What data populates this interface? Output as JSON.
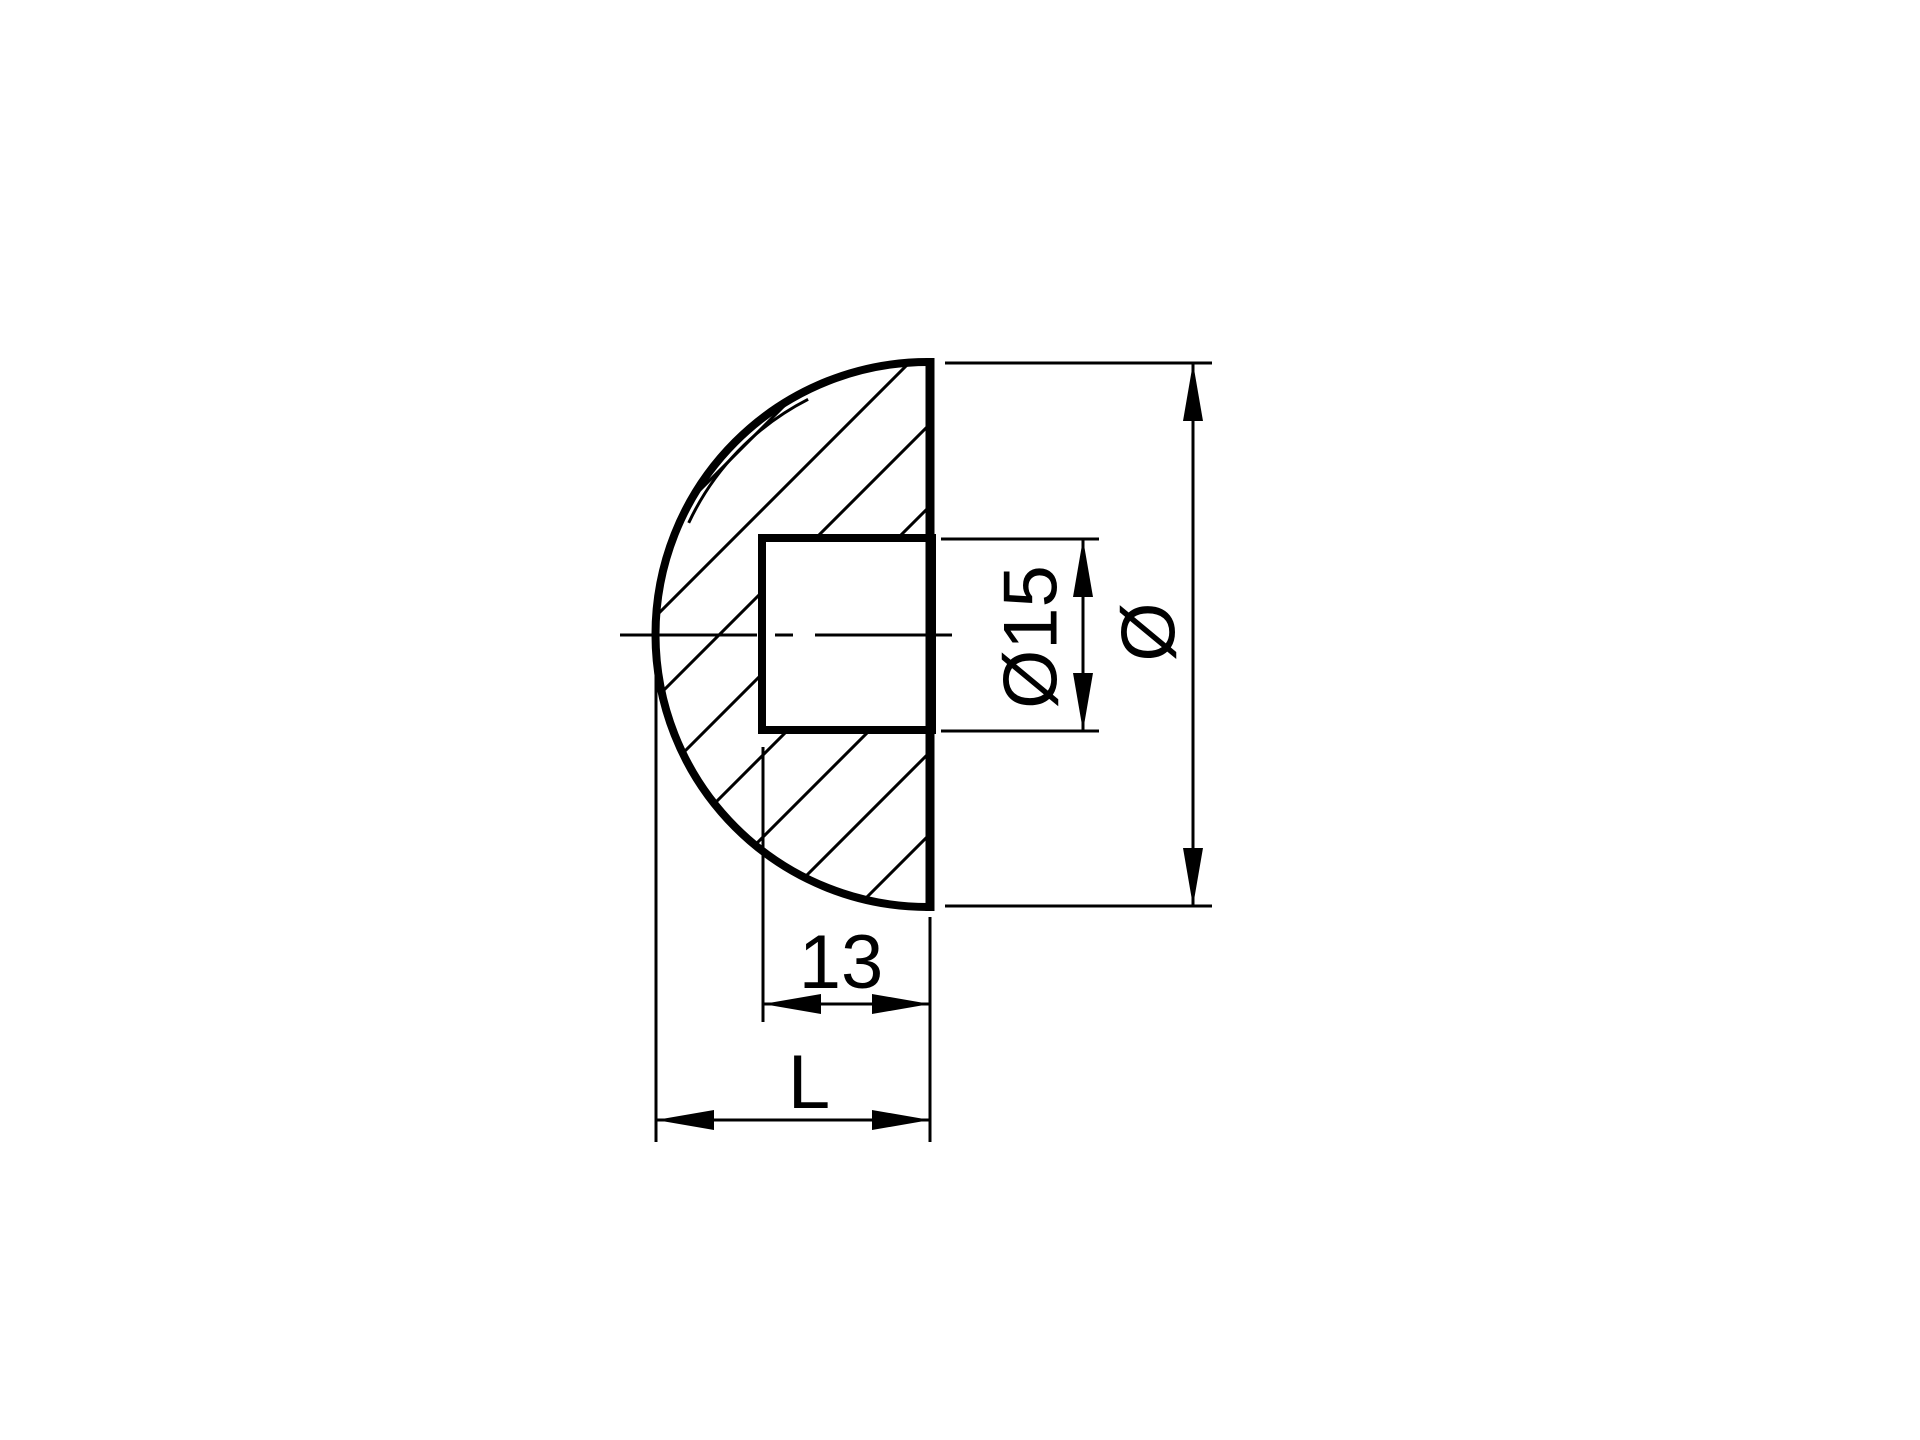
{
  "figure": {
    "kind": "technical-drawing-cross-section",
    "background_color": "#ffffff",
    "line_color": "#000000"
  },
  "dimensions": {
    "overall_diameter": {
      "label": "Ø"
    },
    "bore_diameter": {
      "label": "Ø15"
    },
    "bore_depth": {
      "label": "13"
    },
    "overall_length": {
      "label": "L"
    }
  }
}
